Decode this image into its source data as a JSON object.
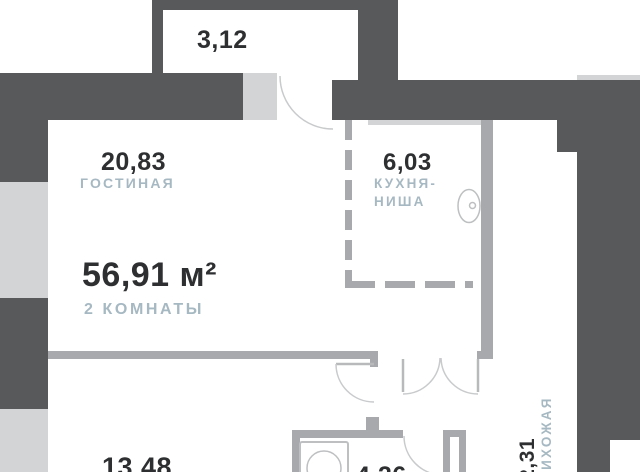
{
  "colors": {
    "wall-dark": "#58595B",
    "wall-mid": "#A7A9AC",
    "wall-light": "#D2D4D5",
    "text-dark": "#2D2F31",
    "text-muted": "#A6B8C2",
    "arc": "#C8CACC",
    "fixture": "#BDBFC1",
    "bg": "#FFFFFF"
  },
  "summary": {
    "total_area": "56,91 м²",
    "rooms_count": "2 КОМНАТЫ"
  },
  "rooms": {
    "balcony": {
      "area": "3,12"
    },
    "living": {
      "area": "20,83",
      "label": "ГОСТИНАЯ"
    },
    "kitchen": {
      "area": "6,03",
      "label_line1": "КУХНЯ-",
      "label_line2": "НИША"
    },
    "bedroom": {
      "area": "13,48"
    },
    "bathroom": {
      "area": "4,26"
    },
    "hallway": {
      "area": "12,31",
      "label": "ПРИХОЖАЯ"
    }
  }
}
